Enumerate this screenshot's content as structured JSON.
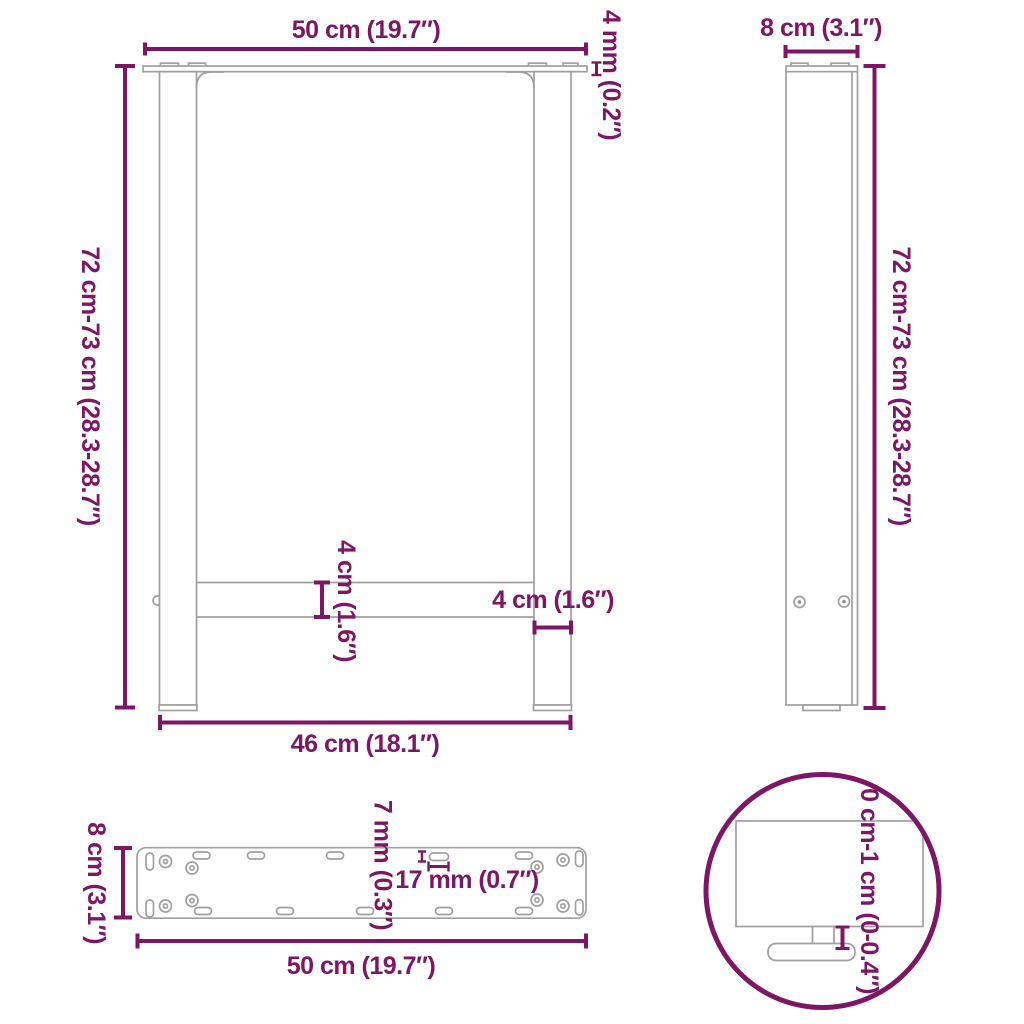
{
  "colors": {
    "accent": "#7D1765",
    "drawing_line": "#A0A0A0"
  },
  "views": {
    "front": {
      "width_top": "50 cm (19.7″)",
      "plate_thickness": "4 mm (0.2″)",
      "height": "72 cm-73 cm (28.3-28.7″)",
      "crossbar_height": "4 cm (1.6″)",
      "leg_width": "4 cm (1.6″)",
      "width_bottom": "46 cm (18.1″)"
    },
    "side": {
      "depth": "8 cm (3.1″)",
      "height": "72 cm-73 cm (28.3-28.7″)"
    },
    "plate": {
      "depth": "8 cm (3.1″)",
      "width": "50 cm (19.7″)",
      "slot_width": "7 mm (0.3″)",
      "slot_length": "17 mm (0.7″)"
    },
    "foot_detail": {
      "adjustment": "0 cm-1 cm (0-0.4″)"
    }
  }
}
